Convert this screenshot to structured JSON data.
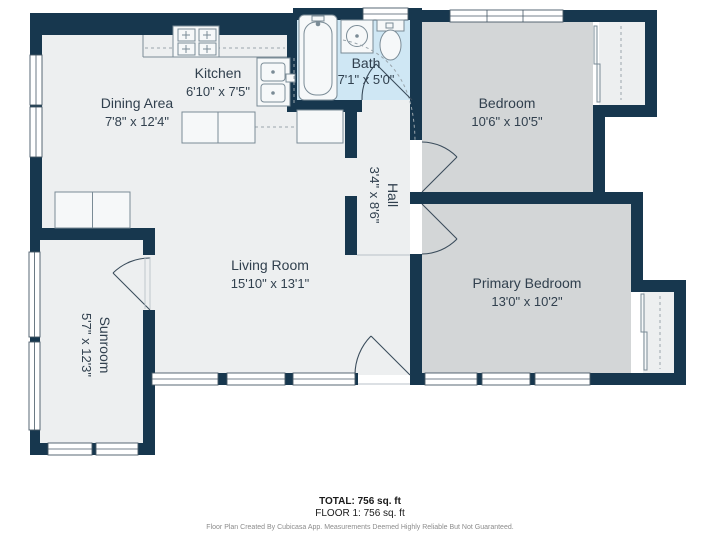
{
  "rooms": {
    "dining": {
      "name": "Dining Area",
      "dims": "7'8\" x 12'4\""
    },
    "kitchen": {
      "name": "Kitchen",
      "dims": "6'10\" x 7'5\""
    },
    "bath": {
      "name": "Bath",
      "dims": "7'1\" x 5'0\""
    },
    "bedroom": {
      "name": "Bedroom",
      "dims": "10'6\" x 10'5\""
    },
    "hall": {
      "name": "Hall",
      "dims": "3'4\" x 8'6\""
    },
    "living": {
      "name": "Living Room",
      "dims": "15'10\" x 13'1\""
    },
    "primary": {
      "name": "Primary Bedroom",
      "dims": "13'0\" x 10'2\""
    },
    "sunroom": {
      "name": "Sunroom",
      "dims": "5'7\" x 12'3\""
    }
  },
  "footer": {
    "total": "TOTAL: 756 sq. ft",
    "floor": "FLOOR 1: 756 sq. ft",
    "disclaimer": "Floor Plan Created By Cubicasa App. Measurements Deemed Highly Reliable But Not Guaranteed."
  },
  "fixtures": [
    {
      "icon": "stove-icon"
    },
    {
      "icon": "kitchen-sink-icon"
    },
    {
      "icon": "bathtub-icon"
    },
    {
      "icon": "bathroom-sink-icon"
    },
    {
      "icon": "toilet-icon"
    },
    {
      "icon": "washer-dryer-icon"
    }
  ],
  "colors": {
    "wall": "#17374E",
    "floor": "#EDEFF0",
    "bedroom_floor": "#D3D6D7",
    "bath_floor": "#CFE7F4",
    "fixture_stroke": "#7A8B96",
    "label_text": "#31404E",
    "dashed": "#9AA5AC",
    "footer_text": "#1A1A1A",
    "disclaimer_text": "#8C8C8C"
  }
}
